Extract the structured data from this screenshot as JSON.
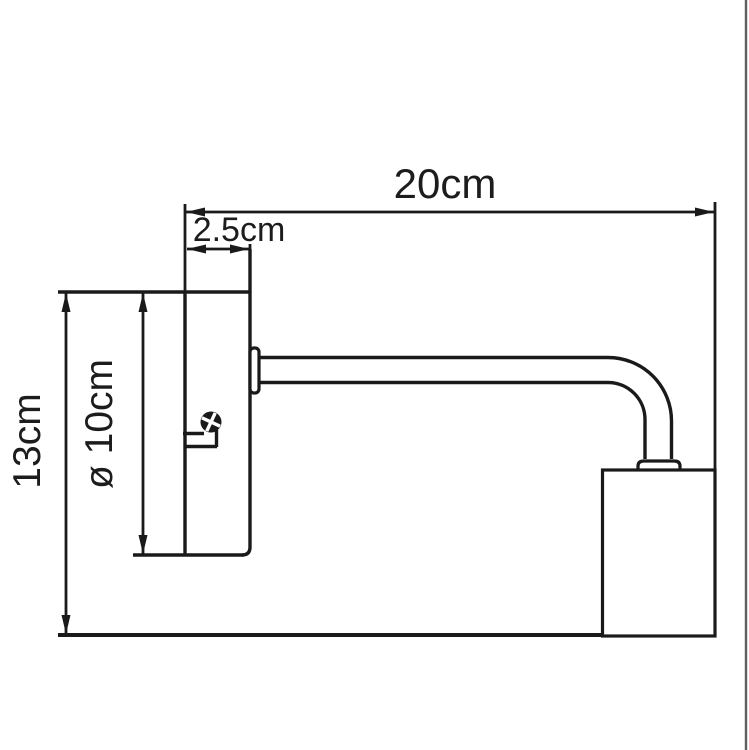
{
  "drawing_title": "Wall lamp technical dimension drawing",
  "dimensions": {
    "overall_width": {
      "label": "20cm"
    },
    "bracket_depth": {
      "label": "2.5cm"
    },
    "overall_height": {
      "label": "13cm"
    },
    "backplate_diameter": {
      "label": "ø 10cm"
    }
  },
  "icons": {
    "screw": "phillips-screw-icon"
  },
  "colors": {
    "line": "#1a1a1a",
    "text": "#1c1c1c",
    "page_border": "#5f5f5f",
    "background": "#ffffff"
  }
}
